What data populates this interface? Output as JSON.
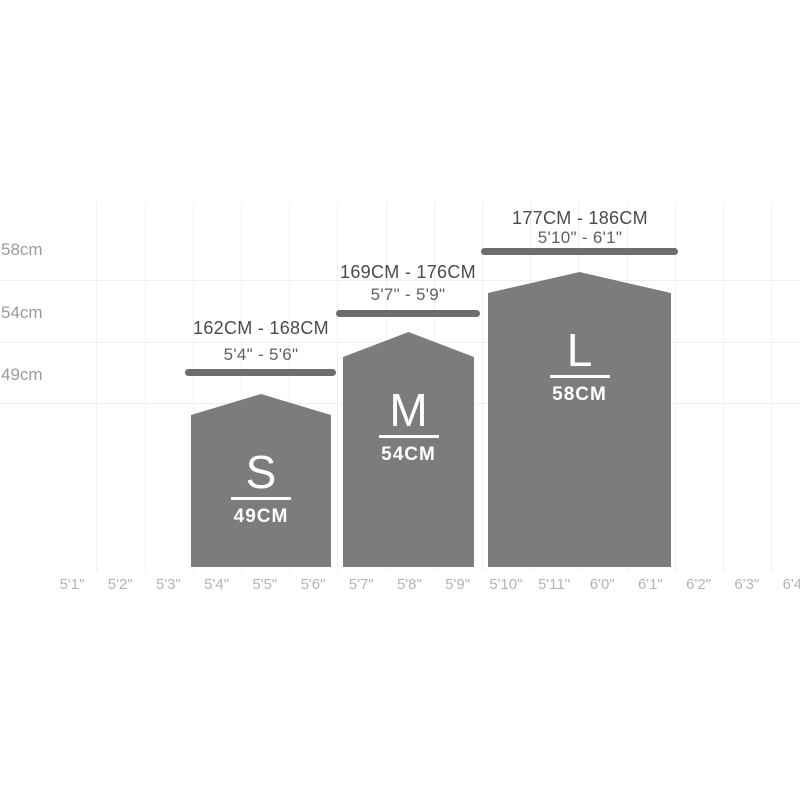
{
  "chart_data": {
    "type": "bar",
    "title": "",
    "description": "Bike frame size guide: rider height ranges mapped to frame sizes S, M and L",
    "grid": "light",
    "legend_position": "none",
    "x_axis": {
      "label": "",
      "tick_labels": [
        "5'1\"",
        "5'2\"",
        "5'3\"",
        "5'4\"",
        "5'5\"",
        "5'6\"",
        "5'7\"",
        "5'8\"",
        "5'9\"",
        "5'10\"",
        "5'11\"",
        "6'0\"",
        "6'1\"",
        "6'2\"",
        "6'3\"",
        "6'4\""
      ]
    },
    "y_axis": {
      "label": "",
      "tick_labels": [
        "58cm",
        "54cm",
        "49cm"
      ]
    },
    "series": [
      {
        "size": "S",
        "frame_size_label": "49CM",
        "frame_size_cm": 49,
        "rider_height_metric": "162CM - 168CM",
        "rider_height_imperial": "5'4\" - 5'6\"",
        "covers_x_range": [
          "5'4\"",
          "5'6\""
        ]
      },
      {
        "size": "M",
        "frame_size_label": "54CM",
        "frame_size_cm": 54,
        "rider_height_metric": "169CM - 176CM",
        "rider_height_imperial": "5'7\" - 5'9\"",
        "covers_x_range": [
          "5'7\"",
          "5'9\""
        ]
      },
      {
        "size": "L",
        "frame_size_label": "58CM",
        "frame_size_cm": 58,
        "rider_height_metric": "177CM - 186CM",
        "rider_height_imperial": "5'10\" - 6'1\"",
        "covers_x_range": [
          "5'10\"",
          "6'1\""
        ]
      }
    ],
    "colors": {
      "bar_fill": "#7c7c7c",
      "range_bar": "#6d6d6d",
      "metric_text": "#4a4a4a",
      "imperial_text": "#5f5f5f",
      "y_tick_text": "#9b9b9b",
      "x_tick_text": "#b5b3b3",
      "gridline": "#f1eff0",
      "bar_inner_text": "#ffffff",
      "background": "#ffffff"
    }
  }
}
